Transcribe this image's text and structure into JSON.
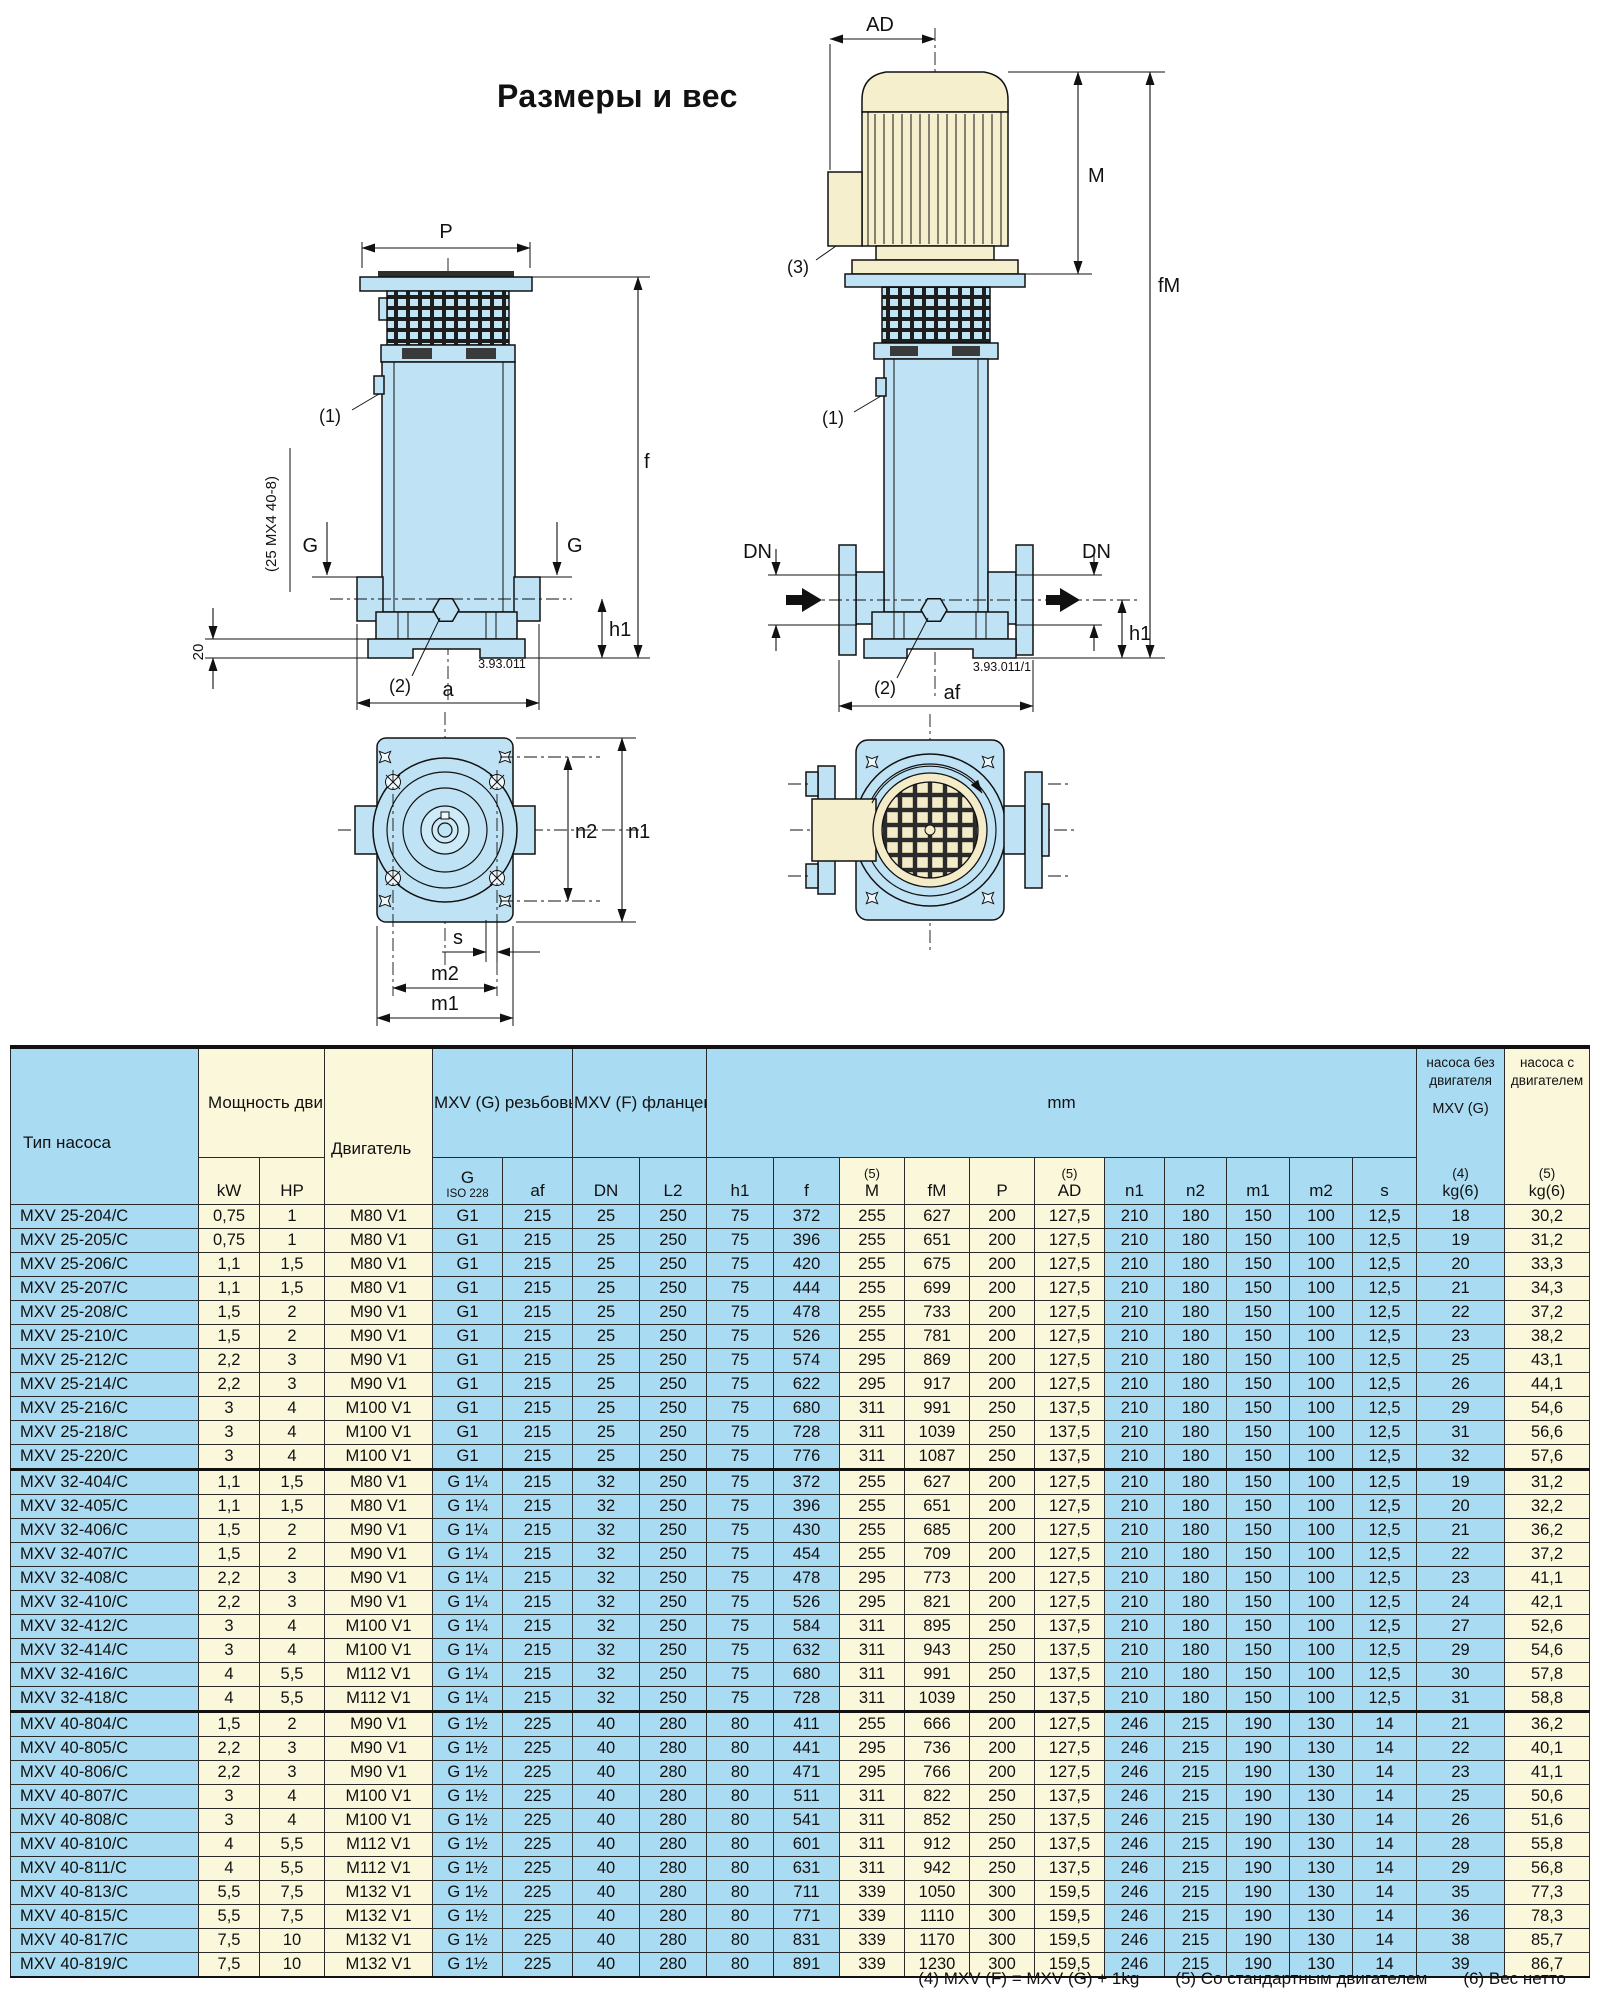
{
  "title": "Размеры и вес",
  "drawings": {
    "left_view": {
      "doc_no": "3.93.011",
      "labels": {
        "P": "P",
        "f": "f",
        "h1": "h1",
        "a": "a",
        "G": "G",
        "callout_1": "(1)",
        "callout_2": "(2)",
        "dim_20": "20",
        "note": "(25 MX4 40-8)"
      }
    },
    "right_view": {
      "doc_no": "3.93.011/1",
      "labels": {
        "AD": "AD",
        "M": "M",
        "fM": "fM",
        "DN": "DN",
        "h1": "h1",
        "af": "af",
        "callout_1": "(1)",
        "callout_2": "(2)",
        "callout_3": "(3)"
      }
    },
    "top_view": {
      "labels": {
        "n1": "n1",
        "n2": "n2",
        "s": "s",
        "m1": "m1",
        "m2": "m2"
      }
    }
  },
  "table": {
    "header": {
      "pump_type": "Тип насоса",
      "power": "Мощность\nдвигателя",
      "motor": "Двигатель",
      "mxv_g": "MXV (G)\nрезьбовые\nраструбы",
      "mxv_f": "MXV (F)\nфланцевые\nраструбы",
      "mm": "mm",
      "kg_without_top": "насоса без\nдвигателя",
      "kg_without_mid": "MXV (G)",
      "kg_without_note": "(4)",
      "kg_with_top": "насоса с\nдвигателем",
      "kg_with_note": "(5)",
      "kg_unit": "kg(6)"
    },
    "units": {
      "kw": "kW",
      "hp": "HP",
      "g": "G",
      "g_iso": "ISO 228",
      "af": "af",
      "dn": "DN",
      "l2": "L2",
      "h1": "h1",
      "f": "f",
      "m_pre": "(5)",
      "m": "M",
      "fm": "fM",
      "p": "P",
      "ad_pre": "(5)",
      "ad": "AD",
      "n1": "n1",
      "n2": "n2",
      "m1": "m1",
      "m2": "m2",
      "s": "s"
    },
    "column_styles": [
      "b",
      "c",
      "c",
      "c",
      "b",
      "b",
      "b",
      "b",
      "b",
      "b",
      "c",
      "c",
      "c",
      "c",
      "b",
      "b",
      "b",
      "b",
      "b",
      "b",
      "c"
    ],
    "blocks": [
      {
        "rows": [
          [
            "MXV 25-204/C",
            "0,75",
            "1",
            "M80 V1",
            "G1",
            "215",
            "25",
            "250",
            "75",
            "372",
            "255",
            "627",
            "200",
            "127,5",
            "210",
            "180",
            "150",
            "100",
            "12,5",
            "18",
            "30,2"
          ],
          [
            "MXV 25-205/C",
            "0,75",
            "1",
            "M80 V1",
            "G1",
            "215",
            "25",
            "250",
            "75",
            "396",
            "255",
            "651",
            "200",
            "127,5",
            "210",
            "180",
            "150",
            "100",
            "12,5",
            "19",
            "31,2"
          ],
          [
            "MXV 25-206/C",
            "1,1",
            "1,5",
            "M80 V1",
            "G1",
            "215",
            "25",
            "250",
            "75",
            "420",
            "255",
            "675",
            "200",
            "127,5",
            "210",
            "180",
            "150",
            "100",
            "12,5",
            "20",
            "33,3"
          ],
          [
            "MXV 25-207/C",
            "1,1",
            "1,5",
            "M80 V1",
            "G1",
            "215",
            "25",
            "250",
            "75",
            "444",
            "255",
            "699",
            "200",
            "127,5",
            "210",
            "180",
            "150",
            "100",
            "12,5",
            "21",
            "34,3"
          ],
          [
            "MXV 25-208/C",
            "1,5",
            "2",
            "M90 V1",
            "G1",
            "215",
            "25",
            "250",
            "75",
            "478",
            "255",
            "733",
            "200",
            "127,5",
            "210",
            "180",
            "150",
            "100",
            "12,5",
            "22",
            "37,2"
          ],
          [
            "MXV 25-210/C",
            "1,5",
            "2",
            "M90 V1",
            "G1",
            "215",
            "25",
            "250",
            "75",
            "526",
            "255",
            "781",
            "200",
            "127,5",
            "210",
            "180",
            "150",
            "100",
            "12,5",
            "23",
            "38,2"
          ],
          [
            "MXV 25-212/C",
            "2,2",
            "3",
            "M90 V1",
            "G1",
            "215",
            "25",
            "250",
            "75",
            "574",
            "295",
            "869",
            "200",
            "127,5",
            "210",
            "180",
            "150",
            "100",
            "12,5",
            "25",
            "43,1"
          ],
          [
            "MXV 25-214/C",
            "2,2",
            "3",
            "M90 V1",
            "G1",
            "215",
            "25",
            "250",
            "75",
            "622",
            "295",
            "917",
            "200",
            "127,5",
            "210",
            "180",
            "150",
            "100",
            "12,5",
            "26",
            "44,1"
          ],
          [
            "MXV 25-216/C",
            "3",
            "4",
            "M100 V1",
            "G1",
            "215",
            "25",
            "250",
            "75",
            "680",
            "311",
            "991",
            "250",
            "137,5",
            "210",
            "180",
            "150",
            "100",
            "12,5",
            "29",
            "54,6"
          ],
          [
            "MXV 25-218/C",
            "3",
            "4",
            "M100 V1",
            "G1",
            "215",
            "25",
            "250",
            "75",
            "728",
            "311",
            "1039",
            "250",
            "137,5",
            "210",
            "180",
            "150",
            "100",
            "12,5",
            "31",
            "56,6"
          ],
          [
            "MXV 25-220/C",
            "3",
            "4",
            "M100 V1",
            "G1",
            "215",
            "25",
            "250",
            "75",
            "776",
            "311",
            "1087",
            "250",
            "137,5",
            "210",
            "180",
            "150",
            "100",
            "12,5",
            "32",
            "57,6"
          ]
        ]
      },
      {
        "rows": [
          [
            "MXV 32-404/C",
            "1,1",
            "1,5",
            "M80 V1",
            "G 1¼",
            "215",
            "32",
            "250",
            "75",
            "372",
            "255",
            "627",
            "200",
            "127,5",
            "210",
            "180",
            "150",
            "100",
            "12,5",
            "19",
            "31,2"
          ],
          [
            "MXV 32-405/C",
            "1,1",
            "1,5",
            "M80 V1",
            "G 1¼",
            "215",
            "32",
            "250",
            "75",
            "396",
            "255",
            "651",
            "200",
            "127,5",
            "210",
            "180",
            "150",
            "100",
            "12,5",
            "20",
            "32,2"
          ],
          [
            "MXV 32-406/C",
            "1,5",
            "2",
            "M90 V1",
            "G 1¼",
            "215",
            "32",
            "250",
            "75",
            "430",
            "255",
            "685",
            "200",
            "127,5",
            "210",
            "180",
            "150",
            "100",
            "12,5",
            "21",
            "36,2"
          ],
          [
            "MXV 32-407/C",
            "1,5",
            "2",
            "M90 V1",
            "G 1¼",
            "215",
            "32",
            "250",
            "75",
            "454",
            "255",
            "709",
            "200",
            "127,5",
            "210",
            "180",
            "150",
            "100",
            "12,5",
            "22",
            "37,2"
          ],
          [
            "MXV 32-408/C",
            "2,2",
            "3",
            "M90 V1",
            "G 1¼",
            "215",
            "32",
            "250",
            "75",
            "478",
            "295",
            "773",
            "200",
            "127,5",
            "210",
            "180",
            "150",
            "100",
            "12,5",
            "23",
            "41,1"
          ],
          [
            "MXV 32-410/C",
            "2,2",
            "3",
            "M90 V1",
            "G 1¼",
            "215",
            "32",
            "250",
            "75",
            "526",
            "295",
            "821",
            "200",
            "127,5",
            "210",
            "180",
            "150",
            "100",
            "12,5",
            "24",
            "42,1"
          ],
          [
            "MXV 32-412/C",
            "3",
            "4",
            "M100 V1",
            "G 1¼",
            "215",
            "32",
            "250",
            "75",
            "584",
            "311",
            "895",
            "250",
            "137,5",
            "210",
            "180",
            "150",
            "100",
            "12,5",
            "27",
            "52,6"
          ],
          [
            "MXV 32-414/C",
            "3",
            "4",
            "M100 V1",
            "G 1¼",
            "215",
            "32",
            "250",
            "75",
            "632",
            "311",
            "943",
            "250",
            "137,5",
            "210",
            "180",
            "150",
            "100",
            "12,5",
            "29",
            "54,6"
          ],
          [
            "MXV 32-416/C",
            "4",
            "5,5",
            "M112 V1",
            "G 1¼",
            "215",
            "32",
            "250",
            "75",
            "680",
            "311",
            "991",
            "250",
            "137,5",
            "210",
            "180",
            "150",
            "100",
            "12,5",
            "30",
            "57,8"
          ],
          [
            "MXV 32-418/C",
            "4",
            "5,5",
            "M112 V1",
            "G 1¼",
            "215",
            "32",
            "250",
            "75",
            "728",
            "311",
            "1039",
            "250",
            "137,5",
            "210",
            "180",
            "150",
            "100",
            "12,5",
            "31",
            "58,8"
          ]
        ]
      },
      {
        "rows": [
          [
            "MXV 40-804/C",
            "1,5",
            "2",
            "M90 V1",
            "G 1½",
            "225",
            "40",
            "280",
            "80",
            "411",
            "255",
            "666",
            "200",
            "127,5",
            "246",
            "215",
            "190",
            "130",
            "14",
            "21",
            "36,2"
          ],
          [
            "MXV 40-805/C",
            "2,2",
            "3",
            "M90 V1",
            "G 1½",
            "225",
            "40",
            "280",
            "80",
            "441",
            "295",
            "736",
            "200",
            "127,5",
            "246",
            "215",
            "190",
            "130",
            "14",
            "22",
            "40,1"
          ],
          [
            "MXV 40-806/C",
            "2,2",
            "3",
            "M90 V1",
            "G 1½",
            "225",
            "40",
            "280",
            "80",
            "471",
            "295",
            "766",
            "200",
            "127,5",
            "246",
            "215",
            "190",
            "130",
            "14",
            "23",
            "41,1"
          ],
          [
            "MXV 40-807/C",
            "3",
            "4",
            "M100 V1",
            "G 1½",
            "225",
            "40",
            "280",
            "80",
            "511",
            "311",
            "822",
            "250",
            "137,5",
            "246",
            "215",
            "190",
            "130",
            "14",
            "25",
            "50,6"
          ],
          [
            "MXV 40-808/C",
            "3",
            "4",
            "M100 V1",
            "G 1½",
            "225",
            "40",
            "280",
            "80",
            "541",
            "311",
            "852",
            "250",
            "137,5",
            "246",
            "215",
            "190",
            "130",
            "14",
            "26",
            "51,6"
          ],
          [
            "MXV 40-810/C",
            "4",
            "5,5",
            "M112 V1",
            "G 1½",
            "225",
            "40",
            "280",
            "80",
            "601",
            "311",
            "912",
            "250",
            "137,5",
            "246",
            "215",
            "190",
            "130",
            "14",
            "28",
            "55,8"
          ],
          [
            "MXV 40-811/C",
            "4",
            "5,5",
            "M112 V1",
            "G 1½",
            "225",
            "40",
            "280",
            "80",
            "631",
            "311",
            "942",
            "250",
            "137,5",
            "246",
            "215",
            "190",
            "130",
            "14",
            "29",
            "56,8"
          ],
          [
            "MXV 40-813/C",
            "5,5",
            "7,5",
            "M132 V1",
            "G 1½",
            "225",
            "40",
            "280",
            "80",
            "711",
            "339",
            "1050",
            "300",
            "159,5",
            "246",
            "215",
            "190",
            "130",
            "14",
            "35",
            "77,3"
          ],
          [
            "MXV 40-815/C",
            "5,5",
            "7,5",
            "M132 V1",
            "G 1½",
            "225",
            "40",
            "280",
            "80",
            "771",
            "339",
            "1110",
            "300",
            "159,5",
            "246",
            "215",
            "190",
            "130",
            "14",
            "36",
            "78,3"
          ],
          [
            "MXV 40-817/C",
            "7,5",
            "10",
            "M132 V1",
            "G 1½",
            "225",
            "40",
            "280",
            "80",
            "831",
            "339",
            "1170",
            "300",
            "159,5",
            "246",
            "215",
            "190",
            "130",
            "14",
            "38",
            "85,7"
          ],
          [
            "MXV 40-819/C",
            "7,5",
            "10",
            "M132 V1",
            "G 1½",
            "225",
            "40",
            "280",
            "80",
            "891",
            "339",
            "1230",
            "300",
            "159,5",
            "246",
            "215",
            "190",
            "130",
            "14",
            "39",
            "86,7"
          ]
        ]
      }
    ]
  },
  "footnotes": [
    "(4) MXV (F) = MXV (G) + 1kg",
    "(5) Со стандартным двигателем",
    "(6) Вес нетто"
  ]
}
